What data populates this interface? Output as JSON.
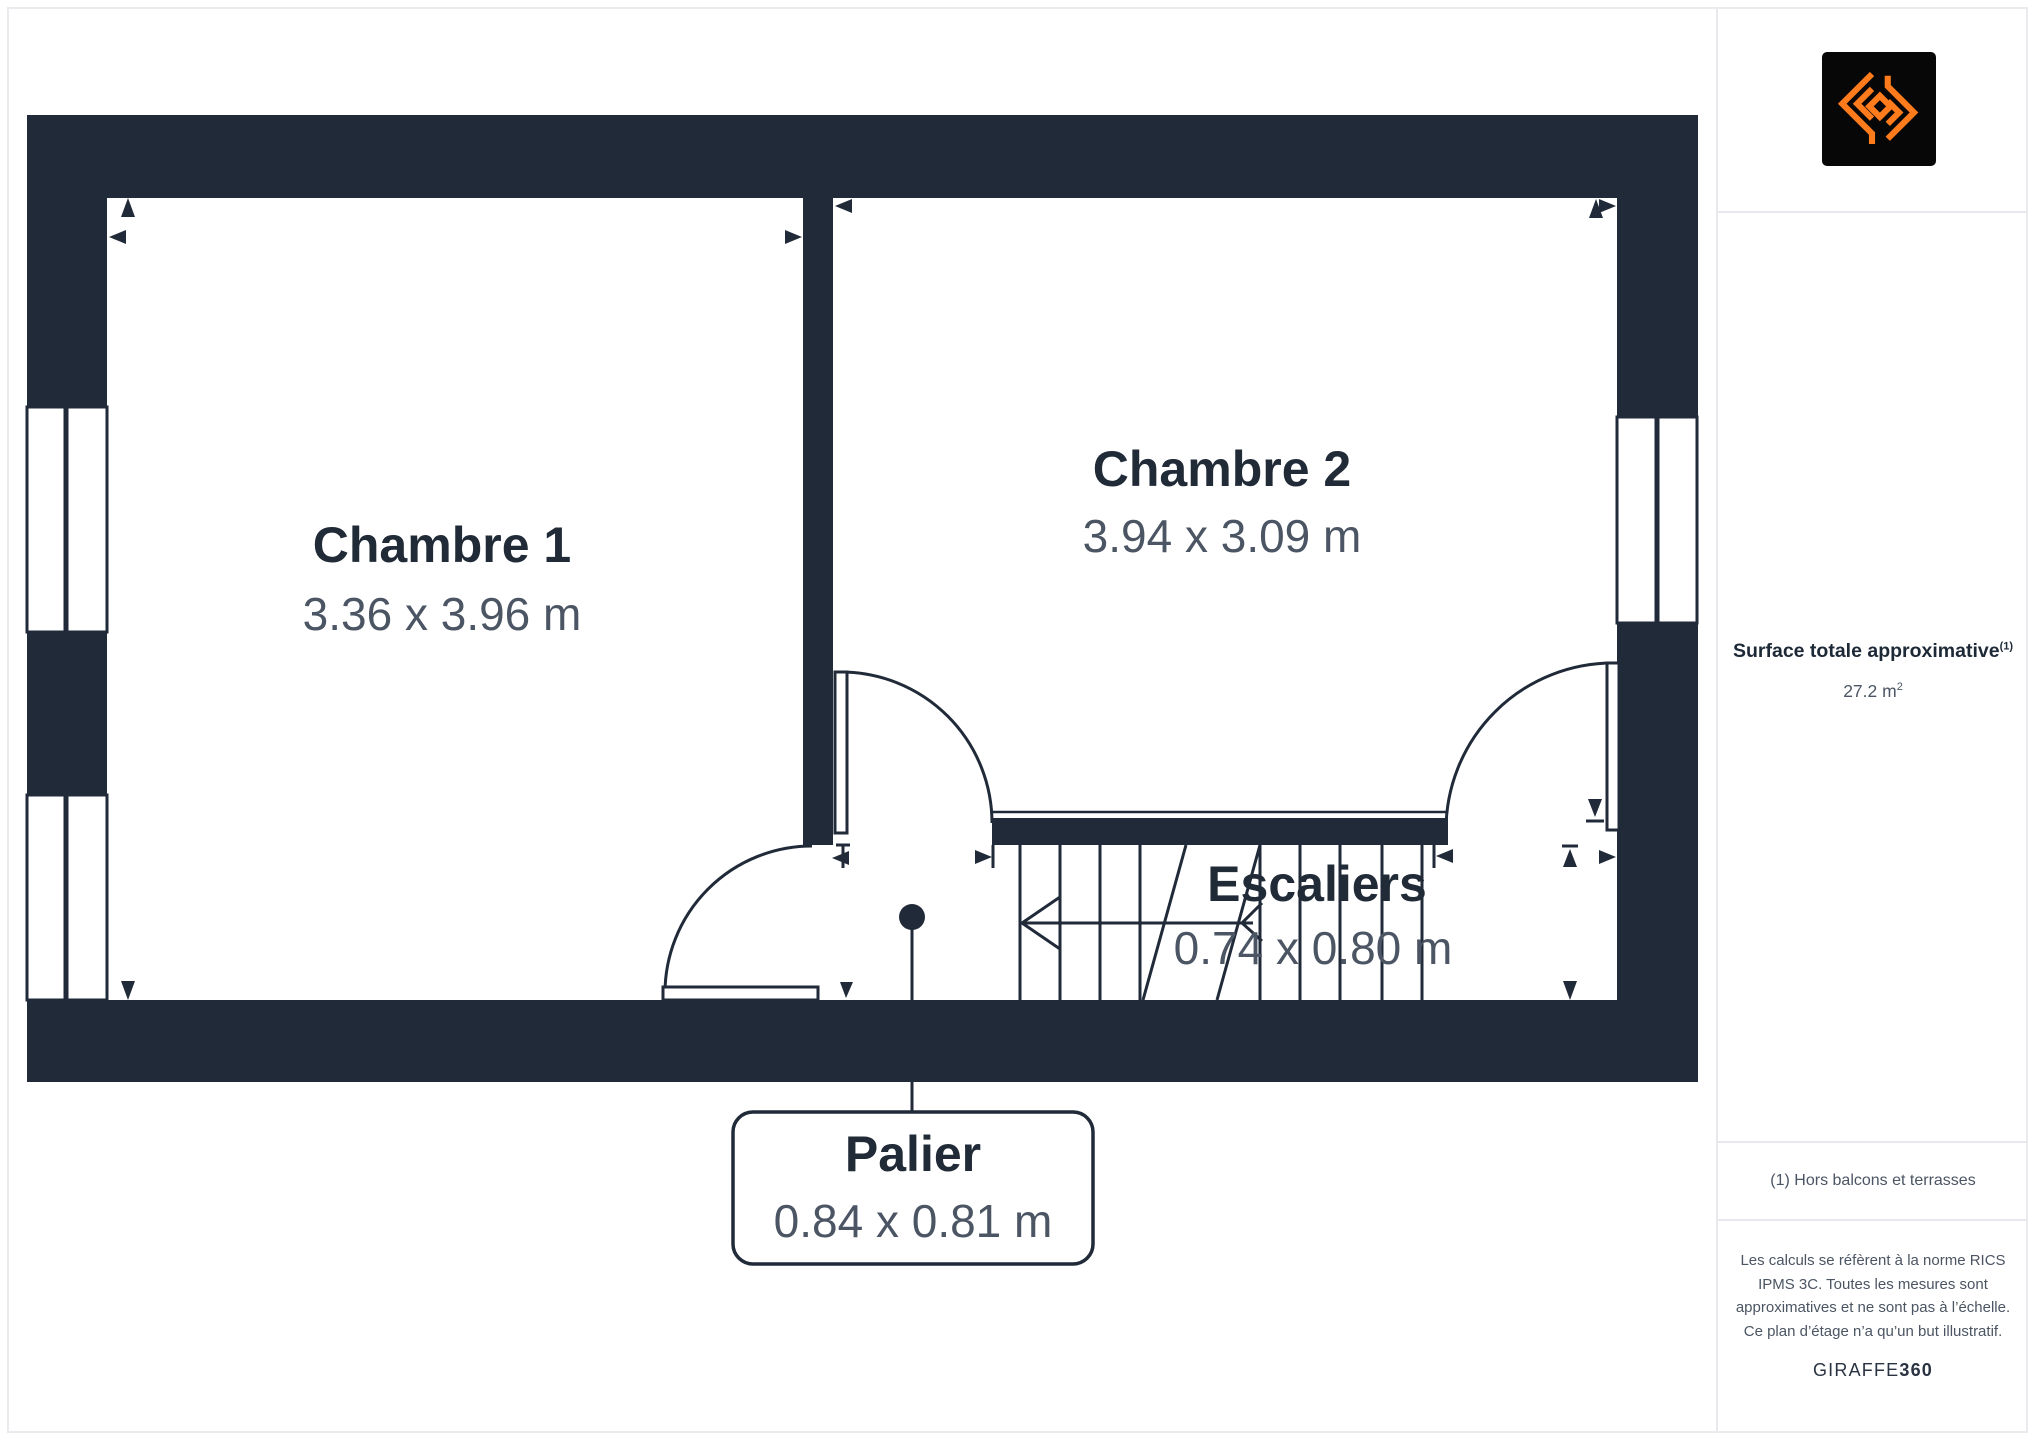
{
  "colors": {
    "wall": "#202a38",
    "room_title_text": "#212b38",
    "dimension_text": "#4b5563",
    "divider": "#e7e9ed",
    "logo_orange": "#ff7b1c",
    "logo_background": "#070707"
  },
  "plan": {
    "rooms": [
      {
        "name": "Chambre 1",
        "dimensions": "3.36 x 3.96 m"
      },
      {
        "name": "Chambre 2",
        "dimensions": "3.94 x 3.09 m"
      }
    ],
    "stairs": {
      "name": "Escaliers",
      "dimensions": "0.74 x 0.80 m"
    },
    "landing": {
      "name": "Palier",
      "dimensions": "0.84 x 0.81 m"
    }
  },
  "sidebar": {
    "logo_icon": "giraffe360-emblem-icon",
    "surface": {
      "label": "Surface totale approximative",
      "footnote_marker": "(1)",
      "value": "27.2 m",
      "value_exponent": "2"
    },
    "footnote": "(1) Hors balcons et terrasses",
    "disclaimer": "Les calculs se réfèrent à la norme RICS IPMS 3C. Toutes les mesures sont approximatives et ne sont pas à l’échelle. Ce plan d’étage n’a qu’un but illustratif.",
    "brand": {
      "primary": "GIRAFFE",
      "bold_suffix": "360"
    }
  }
}
